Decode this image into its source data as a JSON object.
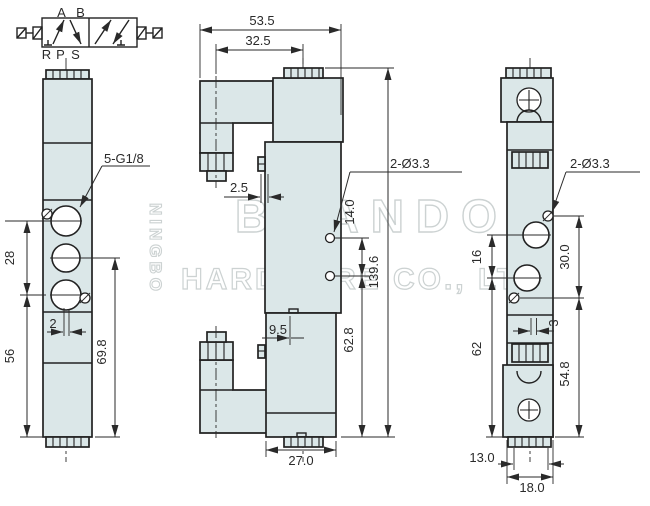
{
  "schematic": {
    "a": "A",
    "b": "B",
    "r": "R",
    "p": "P",
    "s": "S"
  },
  "watermark": {
    "vertical": "NINGBO",
    "name": "BRANDO",
    "subtitle": "HARDWARE CO., LTD"
  },
  "left_view": {
    "thread_label": "5-G1/8",
    "dim_port_spacing": "28",
    "dim_offset": "2",
    "dim_port3_to_bottom": "56",
    "dim_port2_to_bottom": "69.8"
  },
  "front_view": {
    "dim_total_width": "53.5",
    "dim_connector_to_port": "32.5",
    "dim_tab": "2.5",
    "hole_label": "2-Ø3.3",
    "dim_hole_spacing": "14.0",
    "dim_total_height": "139.6",
    "dim_notch": "9.5",
    "dim_hole_to_bottom": "62.8",
    "dim_body_width": "27.0"
  },
  "right_view": {
    "hole_label": "2-Ø3.3",
    "dim_port_spacing": "16",
    "dim_hole_spacing_v": "30.0",
    "dim_center_offset": "3",
    "dim_port_to_bottom": "62",
    "dim_hole_to_bottom": "54.8",
    "dim_hole_spacing_h": "13.0",
    "dim_body_width": "18.0"
  },
  "colors": {
    "body_fill": "#dbe7e8",
    "line": "#222222",
    "dim": "#2a2a2a",
    "watermark": "#ccd2d2"
  }
}
